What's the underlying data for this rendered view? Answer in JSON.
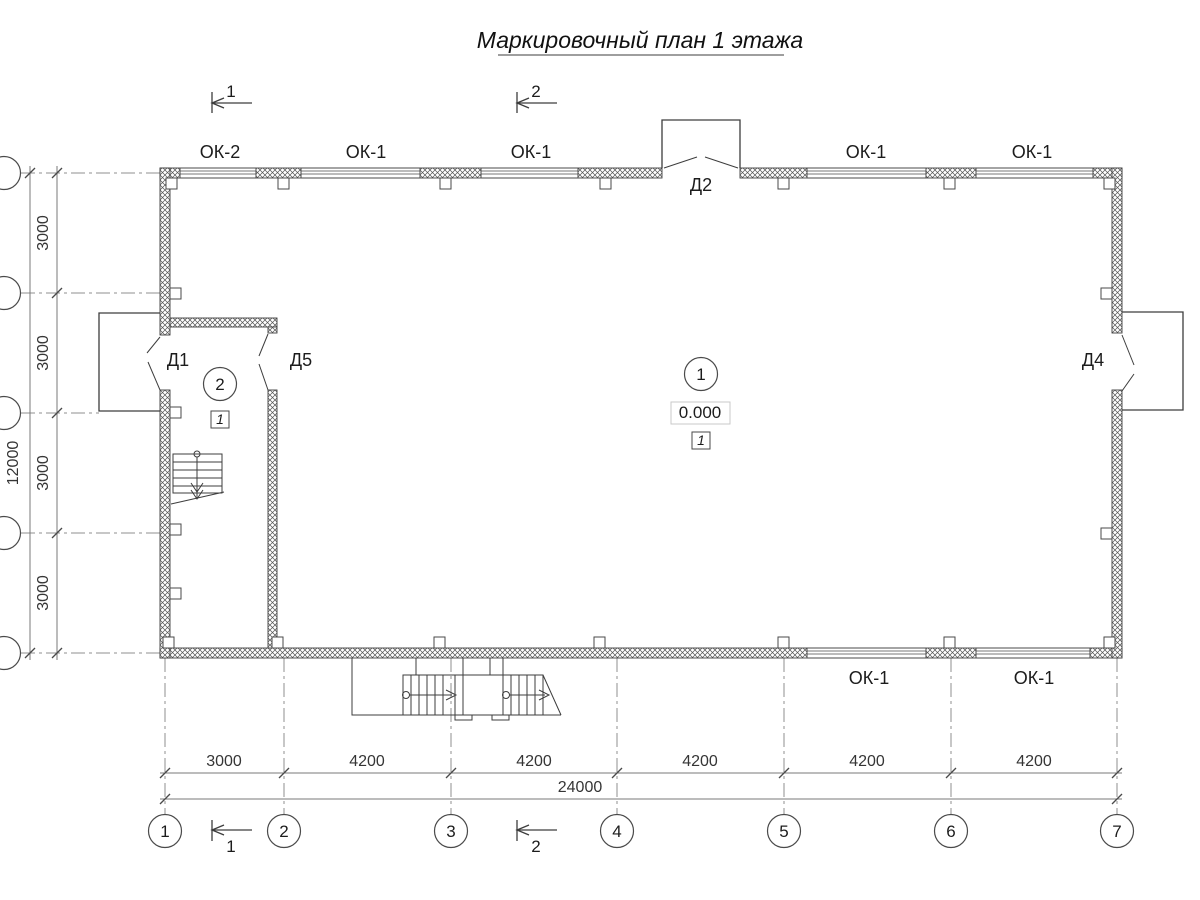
{
  "title": "Маркировочный план 1 этажа",
  "windows": {
    "top": [
      "ОК-2",
      "ОК-1",
      "ОК-1",
      "ОК-1",
      "ОК-1"
    ],
    "bottom": [
      "ОК-1",
      "ОК-1"
    ]
  },
  "doors": {
    "d1": "Д1",
    "d2": "Д2",
    "d4": "Д4",
    "d5": "Д5"
  },
  "rooms": {
    "main": {
      "number": "1",
      "elevation": "0.000",
      "finish": "1"
    },
    "stair_lobby": {
      "number": "2",
      "finish": "1"
    }
  },
  "axes": {
    "cols": [
      "1",
      "2",
      "3",
      "4",
      "5",
      "6",
      "7"
    ],
    "col_spans": [
      "3000",
      "4200",
      "4200",
      "4200",
      "4200",
      "4200"
    ],
    "cols_total": "24000",
    "row_spans": [
      "3000",
      "3000",
      "3000",
      "3000"
    ],
    "rows_total": "12000"
  },
  "sections": {
    "s1": "1",
    "s2": "2"
  }
}
